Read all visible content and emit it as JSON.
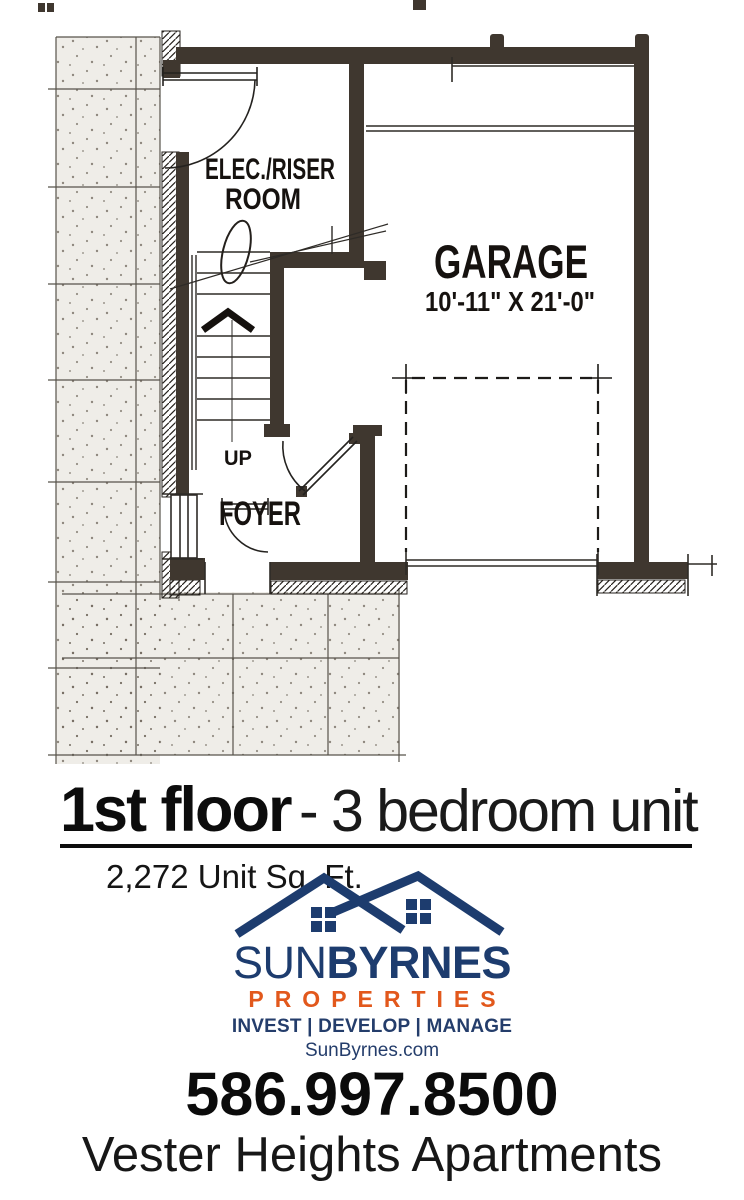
{
  "plan": {
    "elec1": "ELEC./RISER",
    "elec2": "ROOM",
    "garage": "GARAGE",
    "garage_dim": "10'-11\" X 21'-0\"",
    "up": "UP",
    "foyer": "FOYER"
  },
  "title": {
    "floor": "1st floor",
    "rest": "- 3 bedroom unit",
    "sqft": "2,272 Unit Sq. Ft."
  },
  "logo": {
    "brand_sun": "SUN",
    "brand_byrnes": "BYRNES",
    "properties": "PROPERTIES",
    "tagline": "INVEST | DEVELOP | MANAGE",
    "website": "SunByrnes.com"
  },
  "contact": {
    "phone": "586.997.8500",
    "property_name": "Vester Heights Apartments"
  },
  "colors": {
    "navy": "#1d3c6e",
    "orange": "#e2581c",
    "wall": "#3f372f",
    "ink": "#16120f",
    "concrete": "#efede8"
  }
}
